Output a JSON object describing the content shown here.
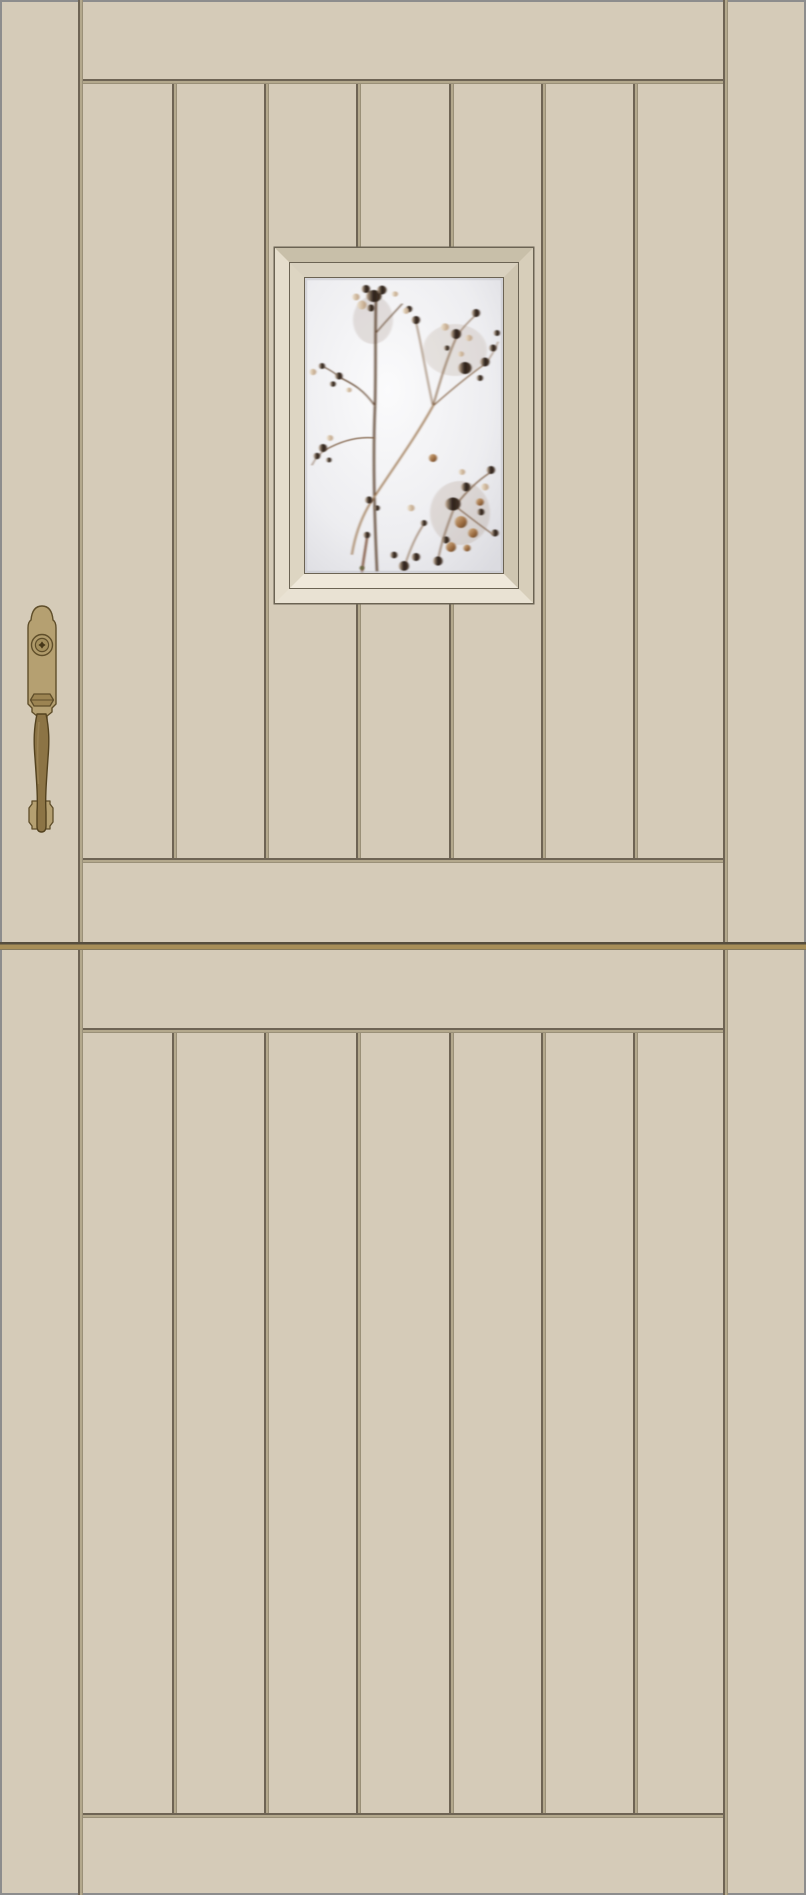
{
  "meta": {
    "title": "Beige dutch-style paneled entry door with botanical glass lite and brass handleset"
  },
  "colors": {
    "face": "#d5cbb8",
    "edge": "#8d8d8d",
    "groove_light": "#b3a88c",
    "groove_dark": "#6e6454",
    "split_gold": "#a78e58",
    "split_dark": "#564e3e",
    "frame_line": "#6b6353",
    "frame_top": "#c8bfa9",
    "frame_right": "#d7ceba",
    "frame_bottom": "#e9e2d3",
    "frame_left": "#e5ddcc",
    "frame2_top": "#d9d1bf",
    "frame2_right": "#cfc6b1",
    "frame2_bottom": "#efe8da",
    "frame2_left": "#ddd5c2",
    "brass": "#b5a071",
    "brass_dark": "#9c8452",
    "brass_line": "#5f4e2a",
    "grip": "#8c7445",
    "grip_line": "#53421f"
  },
  "door": {
    "leaves": [
      "top-leaf",
      "bottom-leaf"
    ],
    "planks_per_leaf": 7,
    "stiles": 2,
    "split_position_px": 943
  },
  "window": {
    "art": "sepia baby's-breath botanical print on frosted glass",
    "frame_style": "double mitered bevel"
  },
  "hardware": {
    "finish": "antique brass",
    "parts": [
      {
        "name": "backplate"
      },
      {
        "name": "deadbolt-cylinder"
      },
      {
        "name": "keyhole-star"
      },
      {
        "name": "thumb-latch"
      },
      {
        "name": "handle-grip"
      },
      {
        "name": "base-finial"
      }
    ]
  }
}
